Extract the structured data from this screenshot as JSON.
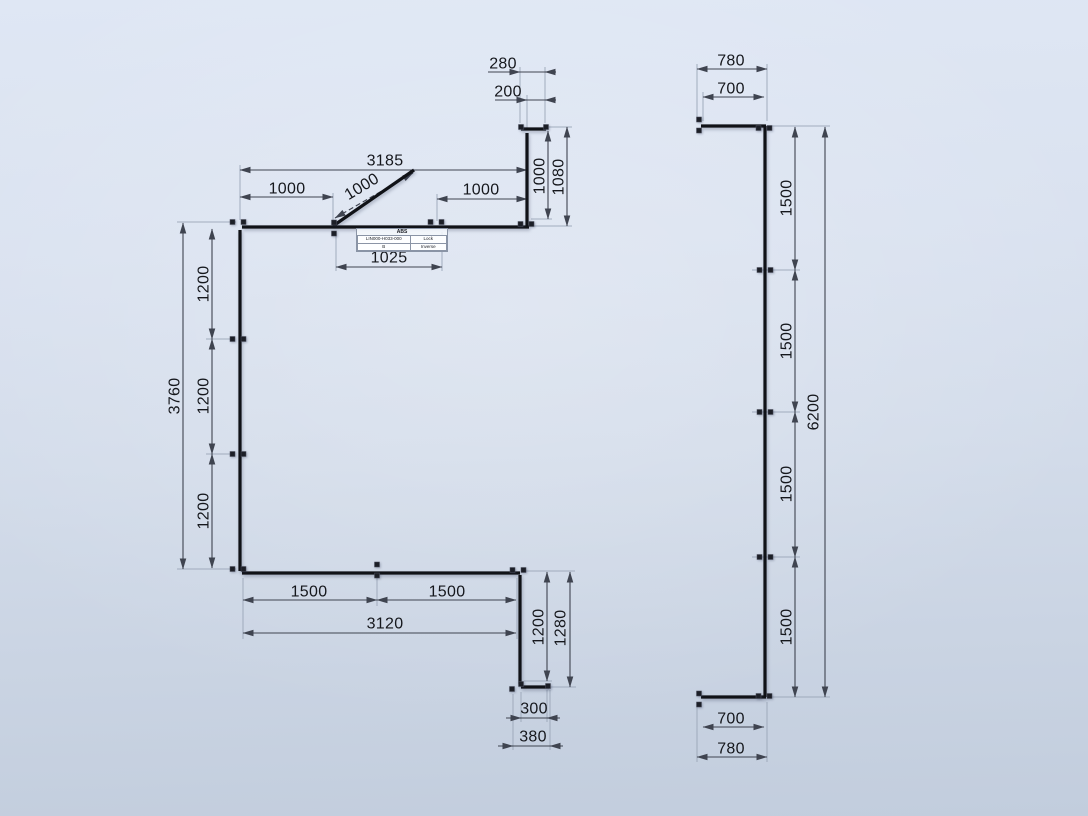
{
  "scene": {
    "background": {
      "top": "#dfe7f4",
      "bottom": "#c2cddd"
    },
    "colors": {
      "member": "#101217",
      "node": "#1c1f27",
      "dim_line": "#3f4450",
      "dim_text": "#15171c",
      "extension": "#9aa5b7"
    }
  },
  "label_box": {
    "title": "ABS",
    "cells": [
      [
        "LIN000-H033-000",
        "Lock"
      ],
      [
        "B",
        "Inverse"
      ]
    ]
  },
  "left_shape": {
    "members": [
      [
        521,
        129,
        546,
        129
      ],
      [
        527,
        133,
        527,
        226
      ],
      [
        242,
        227,
        529,
        227
      ],
      [
        333,
        226,
        414,
        170
      ],
      [
        240,
        230,
        240,
        571
      ],
      [
        242,
        573,
        520,
        573
      ],
      [
        520,
        575,
        520,
        684
      ],
      [
        521,
        687,
        549,
        687
      ]
    ],
    "nodes": [
      [
        238,
        222,
        "h"
      ],
      [
        334,
        228,
        "v"
      ],
      [
        436,
        222,
        "h"
      ],
      [
        526,
        224,
        "h"
      ],
      [
        521,
        127,
        "s"
      ],
      [
        546,
        127,
        "s"
      ],
      [
        238,
        339,
        "h"
      ],
      [
        238,
        454,
        "h"
      ],
      [
        238,
        569,
        "h"
      ],
      [
        377,
        570,
        "v"
      ],
      [
        518,
        570,
        "h"
      ],
      [
        521,
        684,
        "s"
      ],
      [
        548,
        686,
        "s"
      ],
      [
        512,
        689,
        "s"
      ]
    ],
    "extensions": [
      [
        177,
        222,
        236,
        222
      ],
      [
        206,
        339,
        233,
        339
      ],
      [
        206,
        454,
        233,
        454
      ],
      [
        177,
        569,
        236,
        569
      ],
      [
        240,
        165,
        240,
        220
      ],
      [
        333,
        193,
        333,
        221
      ],
      [
        437,
        194,
        437,
        221
      ],
      [
        336,
        233,
        336,
        271
      ],
      [
        442,
        232,
        442,
        271
      ],
      [
        520,
        67,
        520,
        123
      ],
      [
        527,
        95,
        527,
        130
      ],
      [
        545,
        67,
        545,
        123
      ],
      [
        531,
        219,
        552,
        219
      ],
      [
        549,
        127,
        572,
        127
      ],
      [
        532,
        226,
        572,
        226
      ],
      [
        243,
        578,
        243,
        639
      ],
      [
        377,
        578,
        377,
        606
      ],
      [
        517,
        578,
        517,
        639
      ],
      [
        523,
        571,
        575,
        571
      ],
      [
        524,
        681,
        552,
        681
      ],
      [
        551,
        687,
        576,
        687
      ],
      [
        521,
        692,
        521,
        722
      ],
      [
        547,
        690,
        547,
        722
      ],
      [
        513,
        694,
        513,
        750
      ],
      [
        550,
        690,
        550,
        750
      ]
    ],
    "dimensions": [
      {
        "v": "3185",
        "l": [
          240,
          170,
          527,
          170
        ],
        "t": [
          385,
          161
        ],
        "r": 0,
        "s": "out"
      },
      {
        "v": "1000",
        "l": [
          240,
          197,
          333,
          197
        ],
        "t": [
          287,
          189
        ],
        "r": 0,
        "s": "out"
      },
      {
        "v": "1000",
        "l": [
          437,
          199,
          527,
          199
        ],
        "t": [
          481,
          190
        ],
        "r": 0,
        "s": "out"
      },
      {
        "v": "1000",
        "l": [
          335,
          218,
          413,
          173
        ],
        "t": [
          362,
          187
        ],
        "r": -31,
        "s": "out",
        "d": true
      },
      {
        "v": "1025",
        "l": [
          336,
          267,
          442,
          267
        ],
        "t": [
          389,
          258
        ],
        "r": 0,
        "s": "out"
      },
      {
        "v": "280",
        "l": [
          520,
          72,
          545,
          72
        ],
        "t": [
          503,
          64
        ],
        "r": 0,
        "s": "in",
        "lx": [
          488,
          553
        ]
      },
      {
        "v": "200",
        "l": [
          527,
          100,
          545,
          100
        ],
        "t": [
          508,
          92
        ],
        "r": 0,
        "s": "in",
        "lx": [
          495,
          553
        ]
      },
      {
        "v": "1000",
        "l": [
          548,
          131,
          548,
          219
        ],
        "t": [
          540,
          176
        ],
        "r": -90,
        "s": "out"
      },
      {
        "v": "1080",
        "l": [
          567,
          127,
          567,
          226
        ],
        "t": [
          559,
          177
        ],
        "r": -90,
        "s": "out"
      },
      {
        "v": "1200",
        "l": [
          212,
          229,
          212,
          339
        ],
        "t": [
          204,
          284
        ],
        "r": -90,
        "s": "out"
      },
      {
        "v": "1200",
        "l": [
          212,
          339,
          212,
          454
        ],
        "t": [
          204,
          396
        ],
        "r": -90,
        "s": "out"
      },
      {
        "v": "1200",
        "l": [
          212,
          454,
          212,
          568
        ],
        "t": [
          204,
          511
        ],
        "r": -90,
        "s": "out"
      },
      {
        "v": "3760",
        "l": [
          183,
          223,
          183,
          569
        ],
        "t": [
          175,
          396
        ],
        "r": -90,
        "s": "out"
      },
      {
        "v": "1500",
        "l": [
          243,
          600,
          377,
          600
        ],
        "t": [
          309,
          592
        ],
        "r": 0,
        "s": "out"
      },
      {
        "v": "1500",
        "l": [
          377,
          600,
          516,
          600
        ],
        "t": [
          447,
          592
        ],
        "r": 0,
        "s": "out"
      },
      {
        "v": "3120",
        "l": [
          243,
          633,
          516,
          633
        ],
        "t": [
          385,
          624
        ],
        "r": 0,
        "s": "out"
      },
      {
        "v": "1200",
        "l": [
          547,
          572,
          547,
          681
        ],
        "t": [
          539,
          627
        ],
        "r": -90,
        "s": "out"
      },
      {
        "v": "1280",
        "l": [
          570,
          572,
          570,
          687
        ],
        "t": [
          561,
          628
        ],
        "r": -90,
        "s": "out"
      },
      {
        "v": "300",
        "l": [
          521,
          718,
          547,
          718
        ],
        "t": [
          534,
          709
        ],
        "r": 0,
        "s": "in",
        "lx": [
          506,
          560
        ]
      },
      {
        "v": "380",
        "l": [
          513,
          746,
          550,
          746
        ],
        "t": [
          533,
          737
        ],
        "r": 0,
        "s": "in",
        "lx": [
          498,
          563
        ]
      }
    ]
  },
  "right_shape": {
    "members": [
      [
        701,
        126,
        766,
        126
      ],
      [
        765,
        126,
        765,
        697
      ],
      [
        701,
        697,
        766,
        697
      ]
    ],
    "nodes": [
      [
        699,
        125,
        "v"
      ],
      [
        764,
        128,
        "h"
      ],
      [
        765,
        270,
        "h"
      ],
      [
        765,
        412,
        "h"
      ],
      [
        765,
        557,
        "h"
      ],
      [
        699,
        699,
        "v"
      ],
      [
        764,
        696,
        "h"
      ]
    ],
    "extensions": [
      [
        697,
        64,
        697,
        121
      ],
      [
        767,
        64,
        767,
        121
      ],
      [
        703,
        92,
        703,
        121
      ],
      [
        770,
        126,
        830,
        126
      ],
      [
        752,
        270,
        800,
        270
      ],
      [
        752,
        412,
        800,
        412
      ],
      [
        752,
        557,
        800,
        557
      ],
      [
        770,
        697,
        830,
        697
      ],
      [
        697,
        702,
        697,
        762
      ],
      [
        767,
        702,
        767,
        762
      ]
    ],
    "dimensions": [
      {
        "v": "780",
        "l": [
          697,
          69,
          767,
          69
        ],
        "t": [
          731,
          61
        ],
        "r": 0,
        "s": "out"
      },
      {
        "v": "700",
        "l": [
          703,
          97,
          764,
          97
        ],
        "t": [
          731,
          89
        ],
        "r": 0,
        "s": "out"
      },
      {
        "v": "1500",
        "l": [
          795,
          127,
          795,
          270
        ],
        "t": [
          787,
          198
        ],
        "r": -90,
        "s": "out"
      },
      {
        "v": "1500",
        "l": [
          795,
          270,
          795,
          412
        ],
        "t": [
          787,
          341
        ],
        "r": -90,
        "s": "out"
      },
      {
        "v": "1500",
        "l": [
          795,
          412,
          795,
          557
        ],
        "t": [
          787,
          484
        ],
        "r": -90,
        "s": "out"
      },
      {
        "v": "1500",
        "l": [
          795,
          557,
          795,
          697
        ],
        "t": [
          787,
          627
        ],
        "r": -90,
        "s": "out"
      },
      {
        "v": "6200",
        "l": [
          825,
          127,
          825,
          697
        ],
        "t": [
          814,
          412
        ],
        "r": -90,
        "s": "out"
      },
      {
        "v": "700",
        "l": [
          703,
          727,
          764,
          727
        ],
        "t": [
          731,
          719
        ],
        "r": 0,
        "s": "out"
      },
      {
        "v": "780",
        "l": [
          697,
          757,
          767,
          757
        ],
        "t": [
          731,
          749
        ],
        "r": 0,
        "s": "out"
      }
    ]
  }
}
